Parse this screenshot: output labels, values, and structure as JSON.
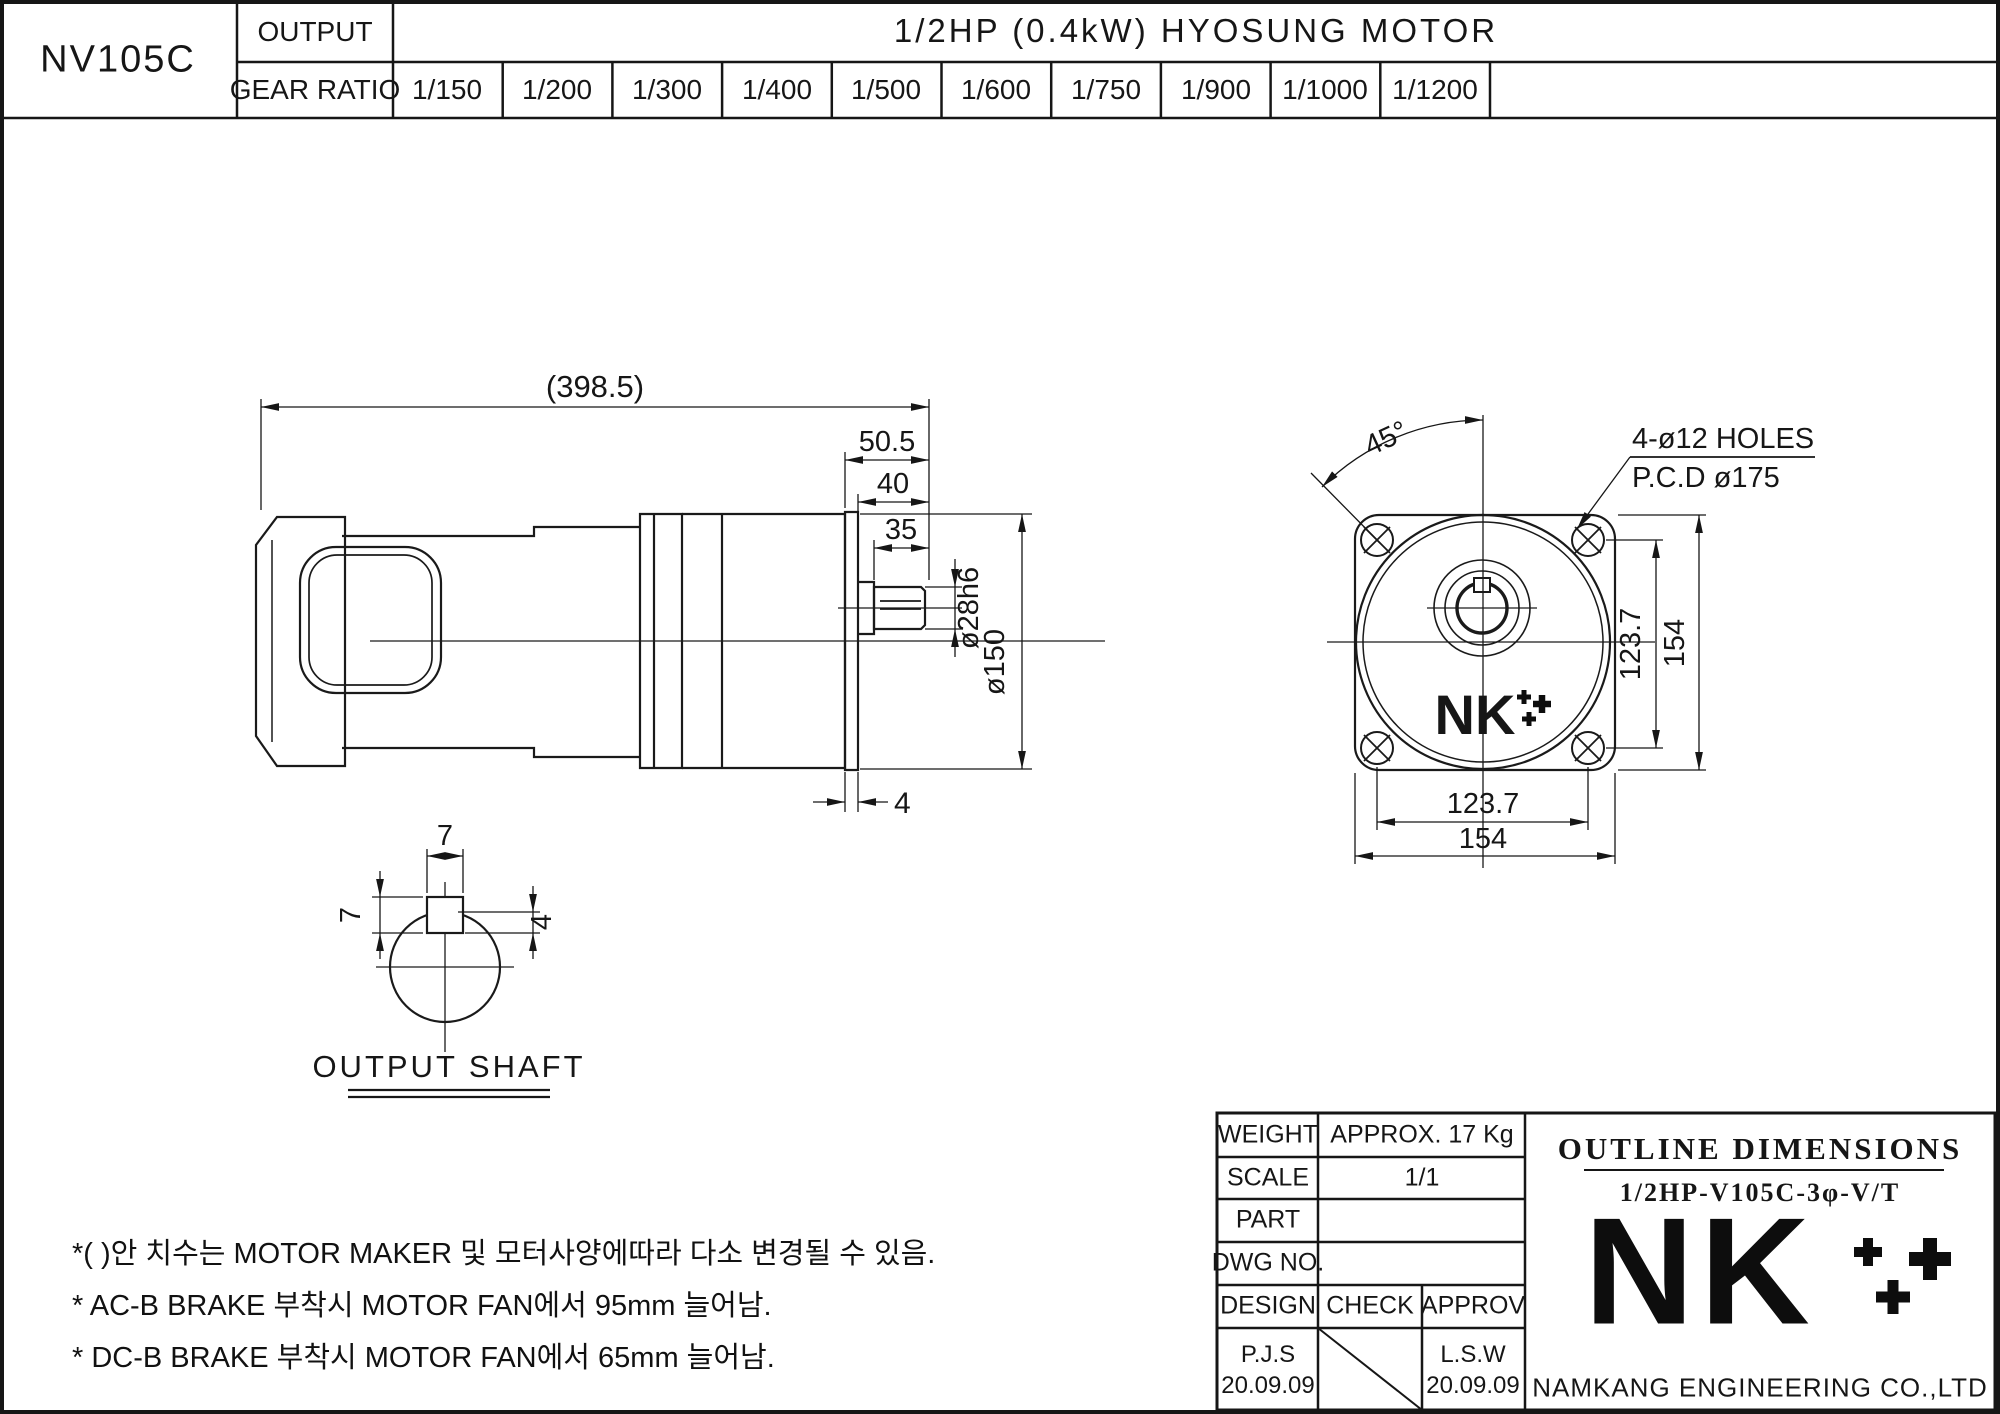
{
  "header": {
    "model": "NV105C",
    "output_label": "OUTPUT",
    "motor_title": "1/2HP (0.4kW) HYOSUNG MOTOR",
    "gear_ratio_label": "GEAR RATIO",
    "gear_ratios": [
      "1/150",
      "1/200",
      "1/300",
      "1/400",
      "1/500",
      "1/600",
      "1/750",
      "1/900",
      "1/1000",
      "1/1200"
    ]
  },
  "side_view": {
    "dims": {
      "overall_length": "(398.5)",
      "gearhead_length": "50.5",
      "shaft_section": "40",
      "shaft_length": "35",
      "shaft_dia": "ø28h6",
      "body_dia": "ø150",
      "flange_thickness": "4"
    }
  },
  "shaft_detail": {
    "title": "OUTPUT SHAFT",
    "key_width": "7",
    "key_height": "7",
    "key_depth": "4"
  },
  "front_view": {
    "dims": {
      "hole_angle": "45°",
      "holes_note_line1": "4-ø12 HOLES",
      "holes_note_line2": "P.C.D ø175",
      "pcd_vertical": "123.7",
      "flange_vertical": "154",
      "pcd_horizontal": "123.7",
      "flange_horizontal": "154"
    },
    "logo_text": "NK"
  },
  "notes": {
    "line1": "*( )안 치수는 MOTOR MAKER 및 모터사양에따라 다소 변경될 수 있음.",
    "line2": "* AC-B BRAKE 부착시 MOTOR FAN에서 95mm 늘어남.",
    "line3": "* DC-B BRAKE 부착시 MOTOR FAN에서 65mm 늘어남."
  },
  "title_block": {
    "weight_label": "WEIGHT",
    "weight_value": "APPROX. 17 Kg",
    "scale_label": "SCALE",
    "scale_value": "1/1",
    "part_label": "PART",
    "part_value": "",
    "dwg_label": "DWG NO.",
    "dwg_value": "",
    "design_label": "DESIGN",
    "check_label": "CHECK",
    "approv_label": "APPROV",
    "design_sign": "P.J.S",
    "design_date": "20.09.09",
    "approv_sign": "L.S.W",
    "approv_date": "20.09.09",
    "doc_title": "OUTLINE DIMENSIONS",
    "doc_subtitle": "1/2HP-V105C-3φ-V/T",
    "logo_text": "NK",
    "company": "NAMKANG ENGINEERING CO.,LTD"
  },
  "colors": {
    "line": "#1a1a1a",
    "background": "#ffffff"
  }
}
